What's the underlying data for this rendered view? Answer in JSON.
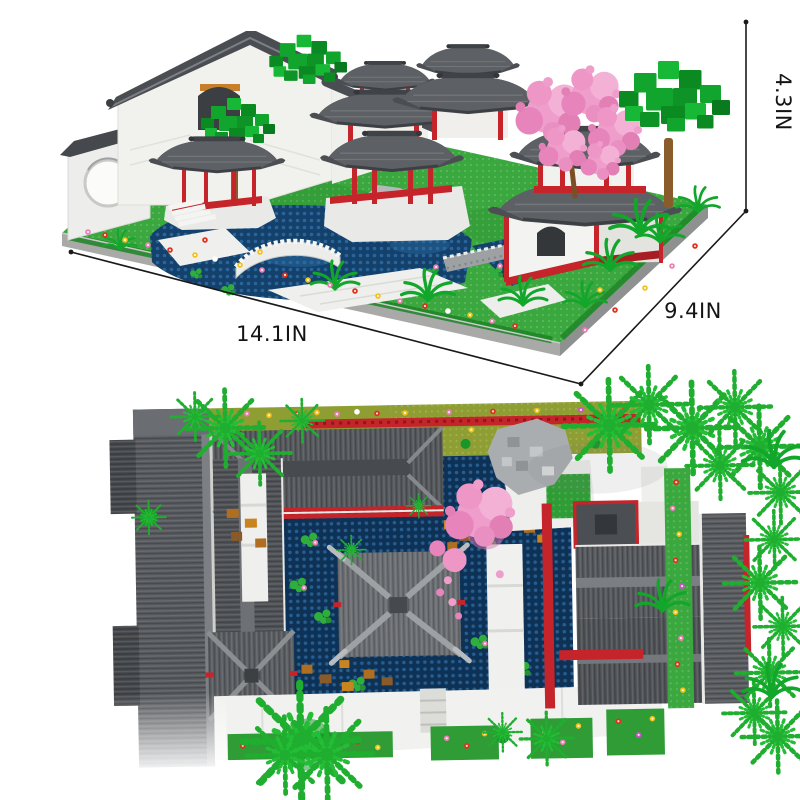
{
  "image": {
    "type": "product-dimensions-figure",
    "background": "#ffffff"
  },
  "dimensions": {
    "height": {
      "label": "4.3IN"
    },
    "width": {
      "label": "14.1IN"
    },
    "depth": {
      "label": "9.4IN"
    }
  },
  "palette": {
    "roof_gray": "#54575b",
    "roof_dark": "#43464a",
    "wall_white": "#f2f2f0",
    "accent_red": "#c4242a",
    "grass_green": "#3aa83e",
    "tree_green": "#12a52e",
    "blossom_pink": "#ef9ecb",
    "pond_blue": "#14416b",
    "olive_bed": "#8f9e33",
    "base_gray": "#a9aaa8",
    "rock_orange": "#c07d22",
    "line_black": "#1a1a1a"
  }
}
